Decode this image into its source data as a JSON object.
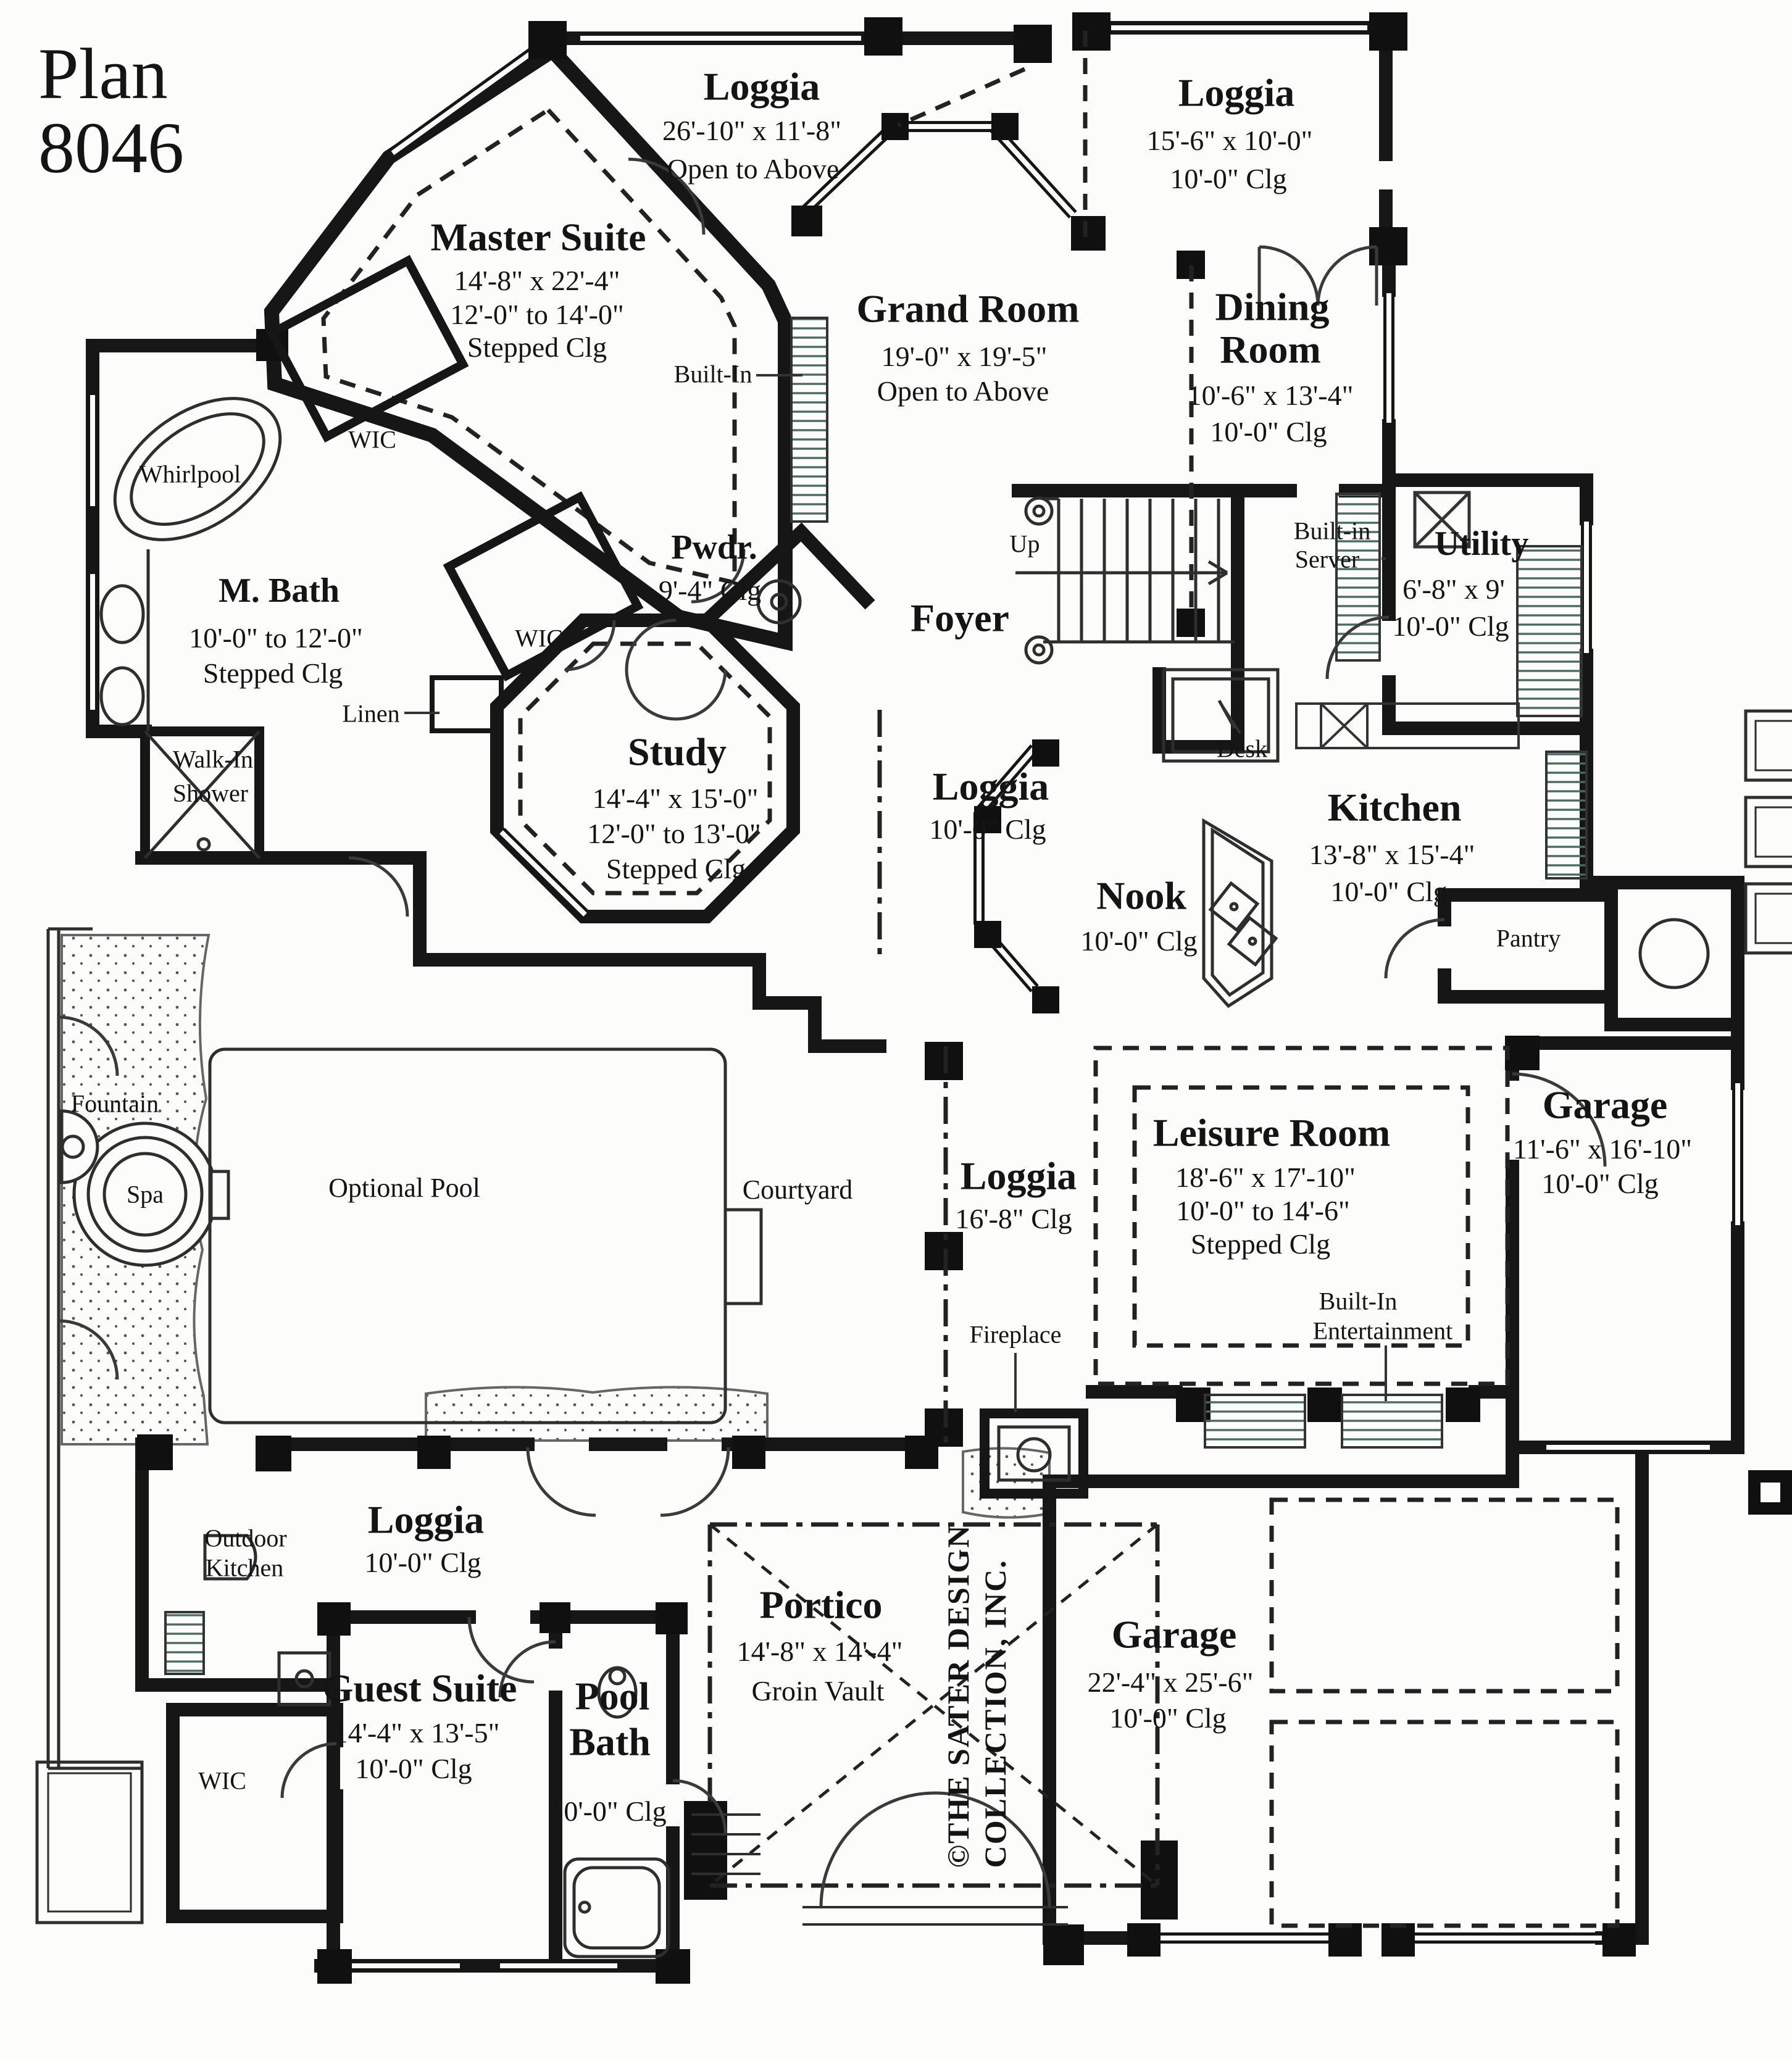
{
  "plan": {
    "title_line1": "Plan",
    "title_line2": "8046"
  },
  "copyright": {
    "line1": "©THE SATER DESIGN",
    "line2": "COLLECTION, INC."
  },
  "rooms": {
    "master_suite": {
      "name": "Master Suite",
      "dim": "14'-8\" x 22'-4\"",
      "clg": "12'-0\" to 14'-0\"",
      "clg2": "Stepped Clg"
    },
    "loggia_master": {
      "name": "Loggia",
      "dim": "26'-10\" x 11'-8\"",
      "note": "Open to Above"
    },
    "loggia_entry": {
      "name": "Loggia",
      "dim": "15'-6\" x 10'-0\"",
      "clg": "10'-0\" Clg"
    },
    "grand_room": {
      "name": "Grand Room",
      "dim": "19'-0\" x 19'-5\"",
      "note": "Open to Above"
    },
    "dining_room": {
      "line1": "Dining",
      "line2": "Room",
      "dim": "10'-6\" x 13'-4\"",
      "clg": "10'-0\" Clg"
    },
    "utility": {
      "name": "Utility",
      "dim": "6'-8\" x 9'",
      "clg": "10'-0\" Clg"
    },
    "m_bath": {
      "name": "M. Bath",
      "clg": "10'-0\" to 12'-0\"",
      "clg2": "Stepped Clg"
    },
    "pwdr": {
      "name": "Pwdr.",
      "clg": "9'-4\" Clg"
    },
    "foyer": {
      "name": "Foyer"
    },
    "study": {
      "name": "Study",
      "dim": "14'-4\" x 15'-0\"",
      "clg": "12'-0\" to 13'-0\"",
      "clg2": "Stepped Clg"
    },
    "loggia_study": {
      "name": "Loggia",
      "clg": "10'-0\" Clg"
    },
    "kitchen": {
      "name": "Kitchen",
      "dim": "13'-8\" x 15'-4\"",
      "clg": "10'-0\" Clg"
    },
    "nook": {
      "name": "Nook",
      "clg": "10'-0\" Clg"
    },
    "garage_side": {
      "name": "Garage",
      "dim": "11'-6\" x 16'-10\"",
      "clg": "10'-0\" Clg"
    },
    "leisure": {
      "name": "Leisure Room",
      "dim": "18'-6\" x 17'-10\"",
      "clg": "10'-0\" to 14'-6\"",
      "clg2": "Stepped Clg"
    },
    "loggia_courtyard": {
      "name": "Loggia",
      "clg": "16'-8\" Clg"
    },
    "loggia_guest": {
      "name": "Loggia",
      "clg": "10'-0\" Clg"
    },
    "guest_suite": {
      "name": "Guest Suite",
      "dim": "14'-4\" x 13'-5\"",
      "clg": "10'-0\" Clg"
    },
    "pool_bath": {
      "line1": "Pool",
      "line2": "Bath",
      "clg": "10'-0\" Clg"
    },
    "portico": {
      "name": "Portico",
      "dim": "14'-8\" x 14'-4\"",
      "note": "Groin Vault"
    },
    "garage_main": {
      "name": "Garage",
      "dim": "22'-4\" x 25'-6\"",
      "clg": "10'-0\" Clg"
    },
    "courtyard": {
      "name": "Courtyard"
    },
    "optional_pool": {
      "name": "Optional Pool"
    },
    "spa": {
      "name": "Spa"
    },
    "fountain": {
      "name": "Fountain"
    }
  },
  "features": {
    "built_in": "Built-In",
    "built_in_server": {
      "line1": "Built-in",
      "line2": "Server"
    },
    "up": "Up",
    "desk": "Desk",
    "whirlpool": "Whirlpool",
    "wic": "WIC",
    "linen": "Linen",
    "walk_in_shower": {
      "line1": "Walk-In",
      "line2": "Shower"
    },
    "pantry": "Pantry",
    "fireplace": "Fireplace",
    "entertainment": {
      "line1": "Built-In",
      "line2": "Entertainment"
    },
    "outdoor_kitchen": {
      "line1": "Outdoor",
      "line2": "Kitchen"
    }
  },
  "colors": {
    "wall": "#161616",
    "thin_line": "#2e2e2e",
    "hatch": "#4a6b63",
    "paper": "#fcfcfa"
  }
}
